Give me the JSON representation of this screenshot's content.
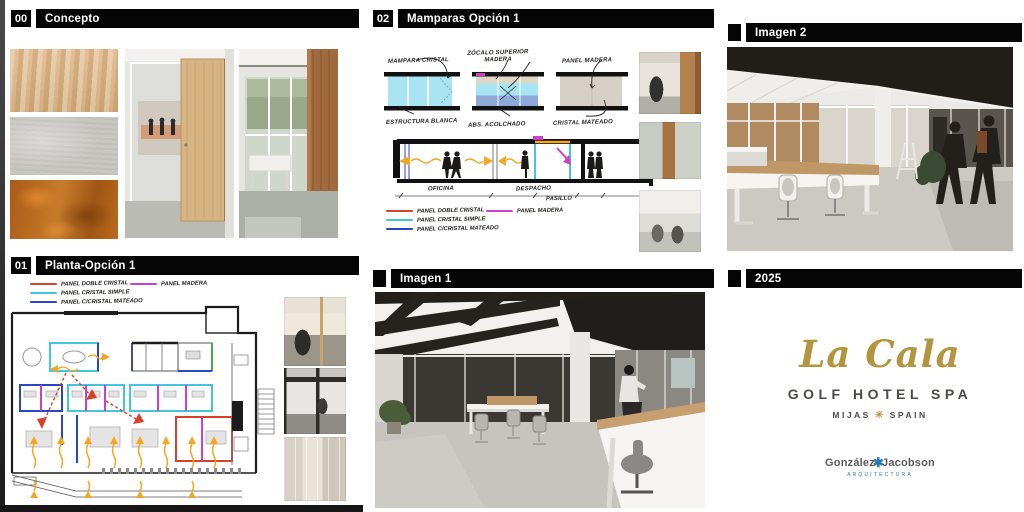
{
  "headers": {
    "concepto": {
      "number": "00",
      "title": "Concepto"
    },
    "planta": {
      "number": "01",
      "title": "Planta-Opción 1"
    },
    "mamparas": {
      "number": "02",
      "title": "Mamparas Opción 1"
    },
    "imagen1": {
      "title": "Imagen 1"
    },
    "imagen2": {
      "title": "Imagen 2"
    },
    "year": {
      "title": "2025"
    }
  },
  "legend": {
    "items": [
      {
        "label": "PANEL DOBLE CRISTAL",
        "color": "#d8402a"
      },
      {
        "label": "PANEL MADERA",
        "color": "#cc3fcc"
      },
      {
        "label": "PANEL CRISTAL SIMPLE",
        "color": "#3fc6e0"
      },
      {
        "label": "PANEL C/CRISTAL MATEADO",
        "color": "#2946c8"
      }
    ]
  },
  "sketch": {
    "labels": {
      "mampara_cristal": "MAMPARA CRISTAL",
      "zocalo": "ZÓCALO SUPERIOR MADERA",
      "panel_madera": "PANEL MADERA",
      "estructura_blanca": "ESTRUCTURA BLANCA",
      "acolchado": "ABS. ACOLCHADO",
      "cristal_mateado": "CRISTAL MATEADO"
    },
    "section": {
      "room1": "OFICINA",
      "room2": "DESPACHO",
      "room3": "PASILLO"
    }
  },
  "branding": {
    "logo_script": "La Cala",
    "logo_line1": "GOLF HOTEL SPA",
    "logo_mijas": "MIJAS",
    "logo_spain": "SPAIN",
    "ornament": "✳",
    "firm_left": "González",
    "firm_mark": "✱",
    "firm_right": "Jacobson",
    "firm_sub": "ARQUITECTURA",
    "gold": "#b3953f",
    "firm_blue": "#2878b8"
  }
}
